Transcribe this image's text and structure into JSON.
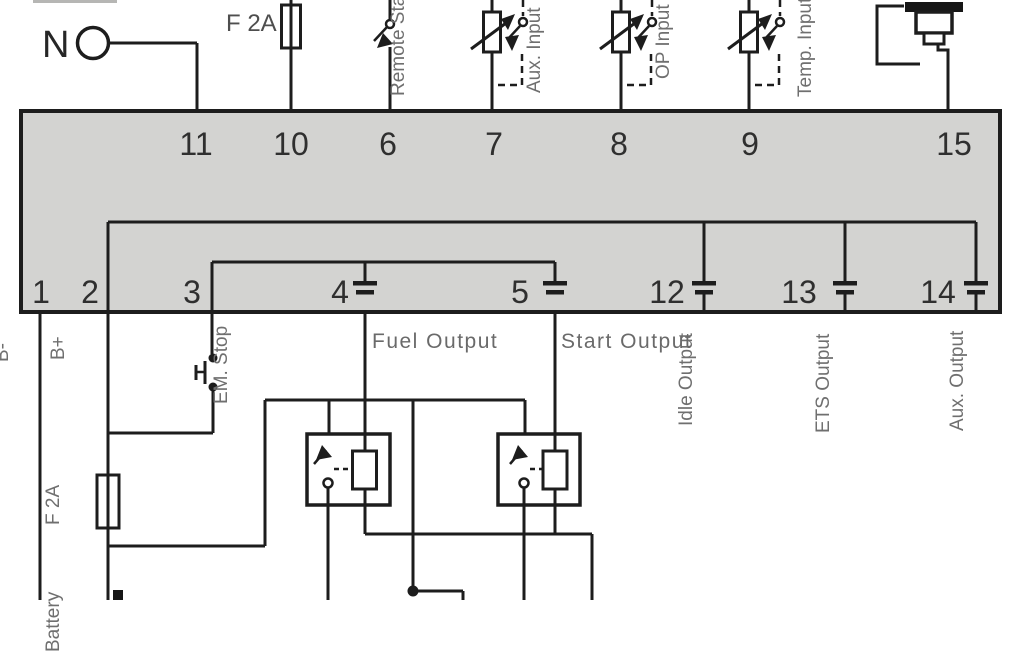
{
  "diagram_type": "engine-controller-wiring-diagram",
  "labels": {
    "neutral": "N",
    "fuse_top": "F 2A",
    "remote_start": "Remote Start",
    "aux_input": "Aux. Input",
    "op_input": "OP Input",
    "temp_input": "Temp. Input",
    "b_minus": "B-",
    "b_plus": "B+",
    "em_stop": "EM. Stop",
    "fuse_bottom": "F 2A",
    "battery": "Battery",
    "fuel_output": "Fuel Output",
    "start_output": "Start Output",
    "idle_output": "Idle Output",
    "ets_output": "ETS Output",
    "aux_output": "Aux. Output"
  },
  "terminals": {
    "top": [
      "11",
      "10",
      "6",
      "7",
      "8",
      "9",
      "15"
    ],
    "bottom": [
      "1",
      "2",
      "3",
      "4",
      "5",
      "12",
      "13",
      "14"
    ]
  },
  "icons": [
    "neutral-terminal-icon",
    "fuse-icon",
    "remote-start-switch-icon",
    "potentiometer-icon",
    "optional-switch-icon",
    "temp-sensor-icon",
    "controller-box",
    "terminal-connector-icon",
    "em-stop-pushbutton-icon",
    "relay-icon",
    "junction-dot-icon",
    "battery-icon"
  ],
  "colors": {
    "wire": "#1d1d1d",
    "box_fill": "#d3d3d1",
    "label_gray": "#6f6f6f",
    "number_color": "#2f2f2f"
  }
}
